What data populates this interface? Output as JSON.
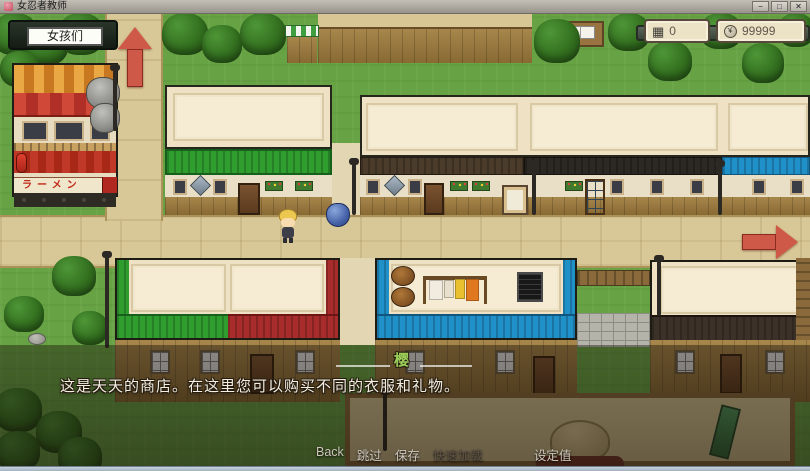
{
  "window": {
    "title": "女忍者教师",
    "controls": {
      "minimize": "−",
      "maximize": "□",
      "close": "✕"
    }
  },
  "hud": {
    "girls_button_label": "女孩们",
    "counters": [
      {
        "name": "counter",
        "glyph": "▦",
        "value": "0"
      },
      {
        "name": "money",
        "glyph": "¥",
        "value": "99999"
      }
    ]
  },
  "scene": {
    "ramen_sign": "ラーメン"
  },
  "dialogue": {
    "speaker": "樱",
    "text": "这是天天的商店。在这里您可以购买不同的衣服和礼物。"
  },
  "menu": {
    "items": [
      {
        "label": "Back",
        "enabled": true
      },
      {
        "label": "跳过",
        "enabled": true
      },
      {
        "label": "保存",
        "enabled": true
      },
      {
        "label": "快速加载",
        "enabled": false
      },
      {
        "label": "设定值",
        "enabled": true
      }
    ]
  },
  "colors": {
    "arrow_red": "#cf5948",
    "speaker_green": "#9ccf5a"
  }
}
